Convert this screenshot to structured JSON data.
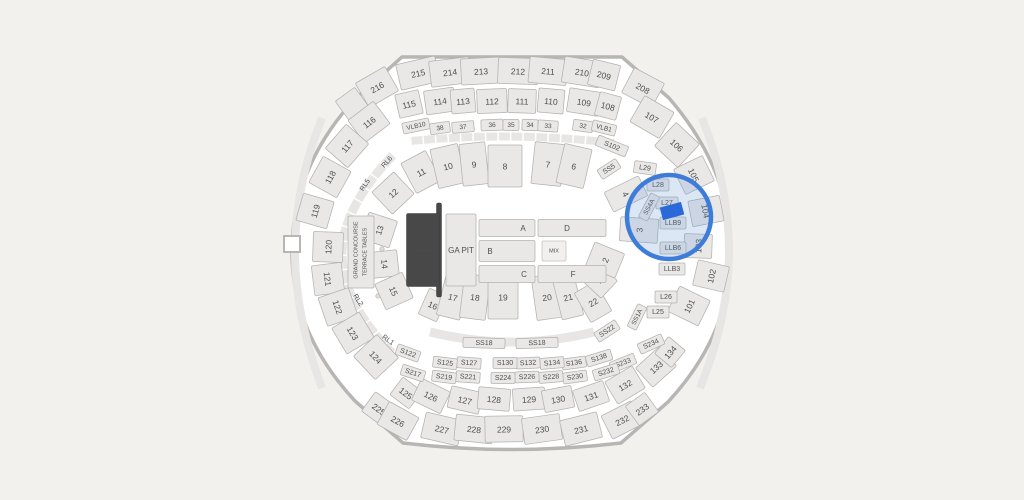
{
  "canvas": {
    "width": 1024,
    "height": 500,
    "background": "#f2f1ee"
  },
  "map": {
    "interior_fill": "#ffffff",
    "outline_stroke": "#b7b6b4",
    "section_fill": "#e9e8e7",
    "section_stroke": "#b3b2b0",
    "label_color": "#4e4e4e",
    "stage_fill": "#484848",
    "highlight": {
      "circle": {
        "cx": 669,
        "cy": 217,
        "r": 42,
        "stroke": "#3d7cd9",
        "stroke_width": 4.5,
        "fill": "rgba(96,144,212,0.22)"
      },
      "marker": {
        "x": 672,
        "y": 211,
        "w": 22,
        "h": 13,
        "rot": -15,
        "fill": "#2a69d8"
      }
    },
    "sections": [
      {
        "t": "216",
        "x": 377,
        "y": 87,
        "w": 34,
        "h": 28,
        "r": -30
      },
      {
        "t": "215",
        "x": 418,
        "y": 73,
        "w": 40,
        "h": 26,
        "r": -13
      },
      {
        "t": "214",
        "x": 450,
        "y": 72,
        "w": 40,
        "h": 26,
        "r": -7
      },
      {
        "t": "213",
        "x": 481,
        "y": 71,
        "w": 40,
        "h": 26,
        "r": -3
      },
      {
        "t": "212",
        "x": 518,
        "y": 71,
        "w": 40,
        "h": 26,
        "r": 2
      },
      {
        "t": "211",
        "x": 548,
        "y": 71,
        "w": 38,
        "h": 26,
        "r": 5
      },
      {
        "t": "210",
        "x": 582,
        "y": 72,
        "w": 38,
        "h": 26,
        "r": 9
      },
      {
        "t": "209",
        "x": 604,
        "y": 75,
        "w": 28,
        "h": 26,
        "r": 14
      },
      {
        "t": "208",
        "x": 643,
        "y": 88,
        "w": 34,
        "h": 28,
        "r": 28
      },
      {
        "t": "",
        "x": 352,
        "y": 104,
        "w": 24,
        "h": 24,
        "r": -36
      },
      {
        "t": "115",
        "x": 409,
        "y": 104,
        "w": 24,
        "h": 24,
        "r": -13
      },
      {
        "t": "114",
        "x": 440,
        "y": 101,
        "w": 30,
        "h": 24,
        "r": -8
      },
      {
        "t": "113",
        "x": 463,
        "y": 101,
        "w": 24,
        "h": 24,
        "r": -5
      },
      {
        "t": "112",
        "x": 492,
        "y": 101,
        "w": 30,
        "h": 24,
        "r": -2
      },
      {
        "t": "111",
        "x": 522,
        "y": 101,
        "w": 28,
        "h": 24,
        "r": 2
      },
      {
        "t": "110",
        "x": 551,
        "y": 101,
        "w": 26,
        "h": 24,
        "r": 5
      },
      {
        "t": "109",
        "x": 584,
        "y": 102,
        "w": 32,
        "h": 24,
        "r": 9
      },
      {
        "t": "108",
        "x": 608,
        "y": 106,
        "w": 22,
        "h": 24,
        "r": 15
      },
      {
        "t": "107",
        "x": 652,
        "y": 117,
        "w": 34,
        "h": 30,
        "r": 30
      },
      {
        "t": "106",
        "x": 677,
        "y": 145,
        "w": 32,
        "h": 32,
        "r": 43
      },
      {
        "t": "116",
        "x": 369,
        "y": 122,
        "w": 32,
        "h": 28,
        "r": -37
      },
      {
        "t": "117",
        "x": 347,
        "y": 146,
        "w": 32,
        "h": 30,
        "r": -49
      },
      {
        "t": "118",
        "x": 330,
        "y": 177,
        "w": 30,
        "h": 32,
        "r": -61
      },
      {
        "t": "119",
        "x": 315,
        "y": 211,
        "w": 28,
        "h": 32,
        "r": -74
      },
      {
        "t": "120",
        "x": 328,
        "y": 247,
        "w": 30,
        "h": 30,
        "r": -88
      },
      {
        "t": "121",
        "x": 328,
        "y": 279,
        "w": 30,
        "h": 30,
        "r": 83
      },
      {
        "t": "122",
        "x": 338,
        "y": 307,
        "w": 30,
        "h": 32,
        "r": 71
      },
      {
        "t": "123",
        "x": 353,
        "y": 333,
        "w": 30,
        "h": 32,
        "r": 59
      },
      {
        "t": "124",
        "x": 376,
        "y": 357,
        "w": 32,
        "h": 32,
        "r": 47
      },
      {
        "t": "105",
        "x": 694,
        "y": 175,
        "w": 28,
        "h": 32,
        "r": 64
      },
      {
        "t": "104",
        "x": 706,
        "y": 211,
        "w": 26,
        "h": 32,
        "r": 79
      },
      {
        "t": "103",
        "x": 698,
        "y": 246,
        "w": 24,
        "h": 28,
        "r": -88
      },
      {
        "t": "102",
        "x": 711,
        "y": 276,
        "w": 26,
        "h": 32,
        "r": -77
      },
      {
        "t": "101",
        "x": 689,
        "y": 306,
        "w": 28,
        "h": 34,
        "r": -64
      },
      {
        "t": "125",
        "x": 406,
        "y": 393,
        "w": 24,
        "h": 22,
        "r": 37
      },
      {
        "t": "126",
        "x": 431,
        "y": 396,
        "w": 32,
        "h": 24,
        "r": 26
      },
      {
        "t": "127",
        "x": 465,
        "y": 400,
        "w": 32,
        "h": 22,
        "r": 13
      },
      {
        "t": "128",
        "x": 494,
        "y": 399,
        "w": 32,
        "h": 22,
        "r": 5
      },
      {
        "t": "129",
        "x": 529,
        "y": 399,
        "w": 32,
        "h": 22,
        "r": -4
      },
      {
        "t": "130",
        "x": 558,
        "y": 399,
        "w": 30,
        "h": 22,
        "r": -11
      },
      {
        "t": "131",
        "x": 591,
        "y": 396,
        "w": 32,
        "h": 22,
        "r": -19
      },
      {
        "t": "132",
        "x": 625,
        "y": 385,
        "w": 32,
        "h": 26,
        "r": -31
      },
      {
        "t": "133",
        "x": 656,
        "y": 367,
        "w": 32,
        "h": 26,
        "r": -42
      },
      {
        "t": "134",
        "x": 670,
        "y": 352,
        "w": 22,
        "h": 22,
        "r": -50
      },
      {
        "t": "225",
        "x": 379,
        "y": 409,
        "w": 26,
        "h": 24,
        "r": 36
      },
      {
        "t": "226",
        "x": 398,
        "y": 421,
        "w": 34,
        "h": 26,
        "r": 29
      },
      {
        "t": "227",
        "x": 442,
        "y": 429,
        "w": 38,
        "h": 26,
        "r": 13
      },
      {
        "t": "228",
        "x": 474,
        "y": 429,
        "w": 38,
        "h": 26,
        "r": 6
      },
      {
        "t": "229",
        "x": 504,
        "y": 429,
        "w": 38,
        "h": 26,
        "r": -1
      },
      {
        "t": "230",
        "x": 542,
        "y": 429,
        "w": 38,
        "h": 26,
        "r": -8
      },
      {
        "t": "231",
        "x": 581,
        "y": 429,
        "w": 38,
        "h": 26,
        "r": -14
      },
      {
        "t": "232",
        "x": 622,
        "y": 420,
        "w": 34,
        "h": 26,
        "r": -27
      },
      {
        "t": "233",
        "x": 642,
        "y": 409,
        "w": 24,
        "h": 24,
        "r": -36
      },
      {
        "t": "VLB10",
        "x": 416,
        "y": 126,
        "w": 27,
        "h": 11,
        "r": -12,
        "f": 6.5
      },
      {
        "t": "38",
        "x": 440,
        "y": 128,
        "w": 20,
        "h": 11,
        "r": -8,
        "f": 6.5
      },
      {
        "t": "37",
        "x": 463,
        "y": 127,
        "w": 22,
        "h": 11,
        "r": -5,
        "f": 6.5
      },
      {
        "t": "36",
        "x": 492,
        "y": 125,
        "w": 22,
        "h": 11,
        "r": -2,
        "f": 6.5
      },
      {
        "t": "35",
        "x": 511,
        "y": 125,
        "w": 16,
        "h": 11,
        "r": 0,
        "f": 6.5
      },
      {
        "t": "34",
        "x": 530,
        "y": 125,
        "w": 16,
        "h": 11,
        "r": 2,
        "f": 6.5
      },
      {
        "t": "33",
        "x": 548,
        "y": 126,
        "w": 20,
        "h": 11,
        "r": 4,
        "f": 6.5
      },
      {
        "t": "32",
        "x": 583,
        "y": 126,
        "w": 20,
        "h": 11,
        "r": 8,
        "f": 6.5
      },
      {
        "t": "VLB1",
        "x": 604,
        "y": 128,
        "w": 24,
        "h": 11,
        "r": 14,
        "f": 6.5
      },
      {
        "t": "11",
        "x": 421,
        "y": 172,
        "w": 28,
        "h": 34,
        "r": -28
      },
      {
        "t": "10",
        "x": 448,
        "y": 166,
        "w": 28,
        "h": 40,
        "r": -13
      },
      {
        "t": "9",
        "x": 474,
        "y": 164,
        "w": 26,
        "h": 42,
        "r": -6
      },
      {
        "t": "8",
        "x": 505,
        "y": 166,
        "w": 34,
        "h": 42,
        "r": 0
      },
      {
        "t": "7",
        "x": 548,
        "y": 164,
        "w": 30,
        "h": 42,
        "r": 6
      },
      {
        "t": "6",
        "x": 574,
        "y": 166,
        "w": 28,
        "h": 40,
        "r": 13
      },
      {
        "t": "12",
        "x": 393,
        "y": 193,
        "w": 30,
        "h": 30,
        "r": -43
      },
      {
        "t": "13",
        "x": 379,
        "y": 230,
        "w": 28,
        "h": 30,
        "r": -72
      },
      {
        "t": "14",
        "x": 385,
        "y": 264,
        "w": 26,
        "h": 26,
        "r": 84
      },
      {
        "t": "15",
        "x": 394,
        "y": 291,
        "w": 28,
        "h": 30,
        "r": 66
      },
      {
        "t": "16",
        "x": 433,
        "y": 305,
        "w": 20,
        "h": 28,
        "r": 24
      },
      {
        "t": "17",
        "x": 453,
        "y": 297,
        "w": 24,
        "h": 42,
        "r": 14
      },
      {
        "t": "18",
        "x": 475,
        "y": 297,
        "w": 26,
        "h": 44,
        "r": 7
      },
      {
        "t": "19",
        "x": 503,
        "y": 297,
        "w": 30,
        "h": 44,
        "r": 0
      },
      {
        "t": "20",
        "x": 547,
        "y": 297,
        "w": 26,
        "h": 44,
        "r": -8
      },
      {
        "t": "21",
        "x": 568,
        "y": 297,
        "w": 22,
        "h": 42,
        "r": -14
      },
      {
        "t": "22",
        "x": 593,
        "y": 302,
        "w": 24,
        "h": 34,
        "r": -30
      },
      {
        "t": "1",
        "x": 599,
        "y": 280,
        "w": 24,
        "h": 28,
        "r": -47
      },
      {
        "t": "2",
        "x": 605,
        "y": 260,
        "w": 26,
        "h": 32,
        "r": -68
      },
      {
        "t": "3",
        "x": 639,
        "y": 230,
        "w": 24,
        "h": 38,
        "r": -86
      },
      {
        "t": "4",
        "x": 626,
        "y": 194,
        "w": 22,
        "h": 38,
        "r": 64
      },
      {
        "t": "L29",
        "x": 645,
        "y": 168,
        "w": 22,
        "h": 12,
        "r": 8,
        "f": 7
      },
      {
        "t": "L28",
        "x": 658,
        "y": 185,
        "w": 22,
        "h": 12,
        "r": 0,
        "f": 7
      },
      {
        "t": "L27",
        "x": 667,
        "y": 203,
        "w": 22,
        "h": 12,
        "r": 0,
        "f": 7
      },
      {
        "t": "LLB9",
        "x": 673,
        "y": 223,
        "w": 26,
        "h": 12,
        "r": 0,
        "f": 7
      },
      {
        "t": "LLB6",
        "x": 673,
        "y": 248,
        "w": 26,
        "h": 12,
        "r": 0,
        "f": 7
      },
      {
        "t": "LLB3",
        "x": 672,
        "y": 269,
        "w": 26,
        "h": 12,
        "r": 0,
        "f": 7
      },
      {
        "t": "L26",
        "x": 666,
        "y": 297,
        "w": 22,
        "h": 12,
        "r": 0,
        "f": 7
      },
      {
        "t": "L25",
        "x": 658,
        "y": 312,
        "w": 22,
        "h": 12,
        "r": 0,
        "f": 7
      },
      {
        "t": "S102",
        "x": 612,
        "y": 146,
        "w": 32,
        "h": 11,
        "r": 22,
        "f": 7
      },
      {
        "t": "SS5",
        "x": 609,
        "y": 169,
        "w": 22,
        "h": 11,
        "r": -33,
        "f": 7
      },
      {
        "t": "SS4A",
        "x": 649,
        "y": 207,
        "w": 27,
        "h": 10,
        "r": -62,
        "f": 6.5
      },
      {
        "t": "SS22",
        "x": 607,
        "y": 331,
        "w": 25,
        "h": 11,
        "r": -33,
        "f": 7
      },
      {
        "t": "SS1A",
        "x": 637,
        "y": 317,
        "w": 25,
        "h": 10,
        "r": -64,
        "f": 6.5
      },
      {
        "t": "SS18",
        "x": 484,
        "y": 343,
        "w": 42,
        "h": 10,
        "r": 2,
        "f": 7
      },
      {
        "t": "SS18",
        "x": 537,
        "y": 343,
        "w": 42,
        "h": 10,
        "r": -2,
        "f": 7
      },
      {
        "t": "S234",
        "x": 651,
        "y": 344,
        "w": 26,
        "h": 11,
        "r": -24,
        "f": 7
      },
      {
        "t": "S233",
        "x": 623,
        "y": 363,
        "w": 26,
        "h": 11,
        "r": -22,
        "f": 7
      },
      {
        "t": "S138",
        "x": 599,
        "y": 358,
        "w": 26,
        "h": 11,
        "r": -17,
        "f": 7
      },
      {
        "t": "S136",
        "x": 574,
        "y": 363,
        "w": 24,
        "h": 11,
        "r": -8,
        "f": 7
      },
      {
        "t": "S134",
        "x": 552,
        "y": 363,
        "w": 24,
        "h": 11,
        "r": -5,
        "f": 7
      },
      {
        "t": "S132",
        "x": 528,
        "y": 363,
        "w": 24,
        "h": 11,
        "r": -3,
        "f": 7
      },
      {
        "t": "S130",
        "x": 505,
        "y": 363,
        "w": 24,
        "h": 11,
        "r": 0,
        "f": 7
      },
      {
        "t": "S127",
        "x": 469,
        "y": 363,
        "w": 24,
        "h": 11,
        "r": 4,
        "f": 7
      },
      {
        "t": "S125",
        "x": 445,
        "y": 363,
        "w": 24,
        "h": 11,
        "r": 7,
        "f": 7
      },
      {
        "t": "S122",
        "x": 408,
        "y": 353,
        "w": 24,
        "h": 11,
        "r": 20,
        "f": 7
      },
      {
        "t": "S232",
        "x": 606,
        "y": 372,
        "w": 26,
        "h": 11,
        "r": -17,
        "f": 7
      },
      {
        "t": "S230",
        "x": 575,
        "y": 377,
        "w": 24,
        "h": 11,
        "r": -8,
        "f": 7
      },
      {
        "t": "S228",
        "x": 551,
        "y": 377,
        "w": 24,
        "h": 11,
        "r": -5,
        "f": 7
      },
      {
        "t": "S226",
        "x": 527,
        "y": 377,
        "w": 24,
        "h": 11,
        "r": -2,
        "f": 7
      },
      {
        "t": "S224",
        "x": 503,
        "y": 378,
        "w": 24,
        "h": 11,
        "r": 0,
        "f": 7
      },
      {
        "t": "S221",
        "x": 468,
        "y": 377,
        "w": 24,
        "h": 11,
        "r": 4,
        "f": 7
      },
      {
        "t": "S219",
        "x": 444,
        "y": 377,
        "w": 24,
        "h": 11,
        "r": 7,
        "f": 7
      },
      {
        "t": "S217",
        "x": 413,
        "y": 373,
        "w": 24,
        "h": 11,
        "r": 18,
        "f": 7
      },
      {
        "t": "RL6",
        "x": 387,
        "y": 162,
        "r": -48,
        "c": "t",
        "f": 7
      },
      {
        "t": "RL5",
        "x": 365,
        "y": 185,
        "r": -56,
        "c": "t",
        "f": 7
      },
      {
        "t": "RL2",
        "x": 358,
        "y": 300,
        "r": 57,
        "c": "t",
        "f": 7
      },
      {
        "t": "RL1",
        "x": 388,
        "y": 340,
        "r": 36,
        "c": "t",
        "f": 7
      },
      {
        "t": "",
        "x": 361,
        "y": 252,
        "w": 26,
        "h": 72,
        "r": 0
      },
      {
        "t": "GRAND CONCOURSE",
        "x": 356,
        "y": 250,
        "r": -90,
        "c": "t",
        "f": 5.5
      },
      {
        "t": "TERRACE TABLES",
        "x": 365,
        "y": 252,
        "r": -90,
        "c": "t",
        "f": 5.5
      },
      {
        "t": "",
        "x": 439,
        "y": 250,
        "w": 5,
        "h": 94,
        "r": 0,
        "c": "stage"
      },
      {
        "t": "STAGE",
        "x": 423,
        "y": 250,
        "w": 33,
        "h": 73,
        "r": 0,
        "c": "stage",
        "f": 4.5
      },
      {
        "t": "GA PIT",
        "x": 461,
        "y": 250,
        "w": 30,
        "h": 72,
        "r": 0,
        "f": 8
      },
      {
        "t": "A",
        "x": 507,
        "y": 228,
        "w": 56,
        "h": 17,
        "r": 0,
        "f": 8,
        "dx": 16
      },
      {
        "t": "B",
        "x": 507,
        "y": 251,
        "w": 56,
        "h": 21,
        "r": 0,
        "f": 8,
        "dx": -17
      },
      {
        "t": "C",
        "x": 507,
        "y": 274,
        "w": 56,
        "h": 17,
        "r": 0,
        "f": 8,
        "dx": 17
      },
      {
        "t": "D",
        "x": 572,
        "y": 228,
        "w": 68,
        "h": 17,
        "r": 0,
        "f": 8,
        "dx": -5
      },
      {
        "t": "F",
        "x": 572,
        "y": 274,
        "w": 68,
        "h": 17,
        "r": 0,
        "f": 8,
        "dx": 1
      },
      {
        "t": "MIX",
        "x": 554,
        "y": 251,
        "w": 24,
        "h": 20,
        "r": 0,
        "c": "mix",
        "f": 5.5
      }
    ]
  }
}
